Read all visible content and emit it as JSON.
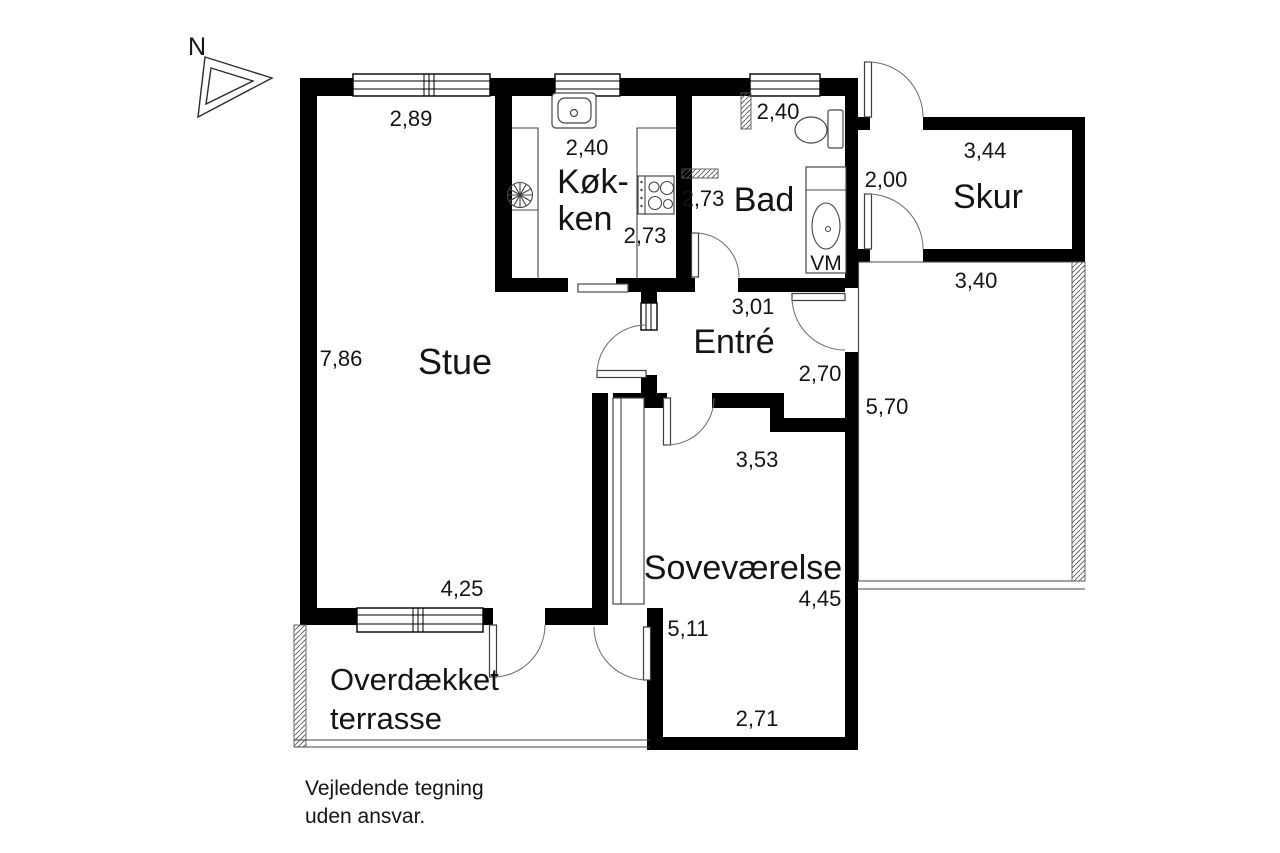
{
  "compass": {
    "north": "N"
  },
  "rooms": {
    "stue": {
      "name": "Stue"
    },
    "kokken": {
      "name_line1": "Køk-",
      "name_line2": "ken"
    },
    "bad": {
      "name": "Bad"
    },
    "entre": {
      "name": "Entré"
    },
    "sovevaerelse": {
      "name": "Soveværelse"
    },
    "skur": {
      "name": "Skur"
    },
    "terrasse": {
      "name_line1": "Overdækket",
      "name_line2": "terrasse"
    }
  },
  "appliances": {
    "washing_machine": "VM"
  },
  "dimensions": {
    "stue_north": "2,89",
    "stue_west": "7,86",
    "stue_south": "4,25",
    "kokken_width": "2,40",
    "kokken_depth": "2,73",
    "bad_width": "2,40",
    "bad_depth": "2,73",
    "entre_width": "3,01",
    "entre_depth": "2,70",
    "sovevaerelse_north": "3,53",
    "sovevaerelse_east": "4,45",
    "sovevaerelse_west": "5,11",
    "sovevaerelse_south": "2,71",
    "skur_width": "3,44",
    "skur_depth": "2,00",
    "patio_north": "3,40",
    "patio_west": "5,70"
  },
  "disclaimer": {
    "line1": "Vejledende tegning",
    "line2": "uden ansvar."
  },
  "colors": {
    "wall": "#000000",
    "line": "#4a4a4a",
    "background": "#ffffff"
  }
}
